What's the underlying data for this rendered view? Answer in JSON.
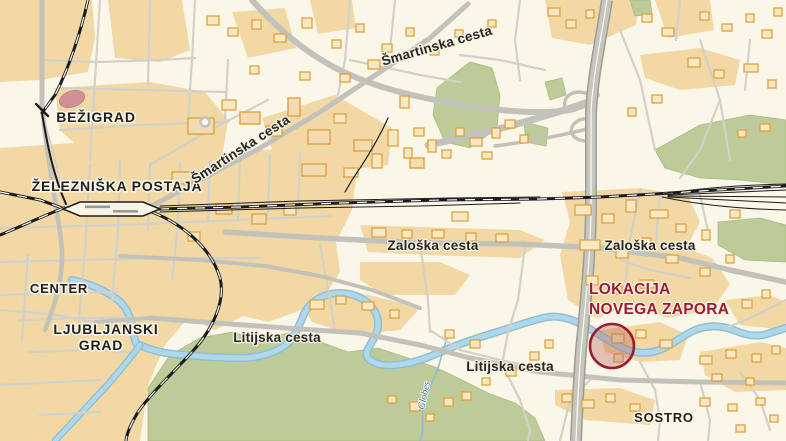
{
  "labels": {
    "districts": {
      "bezigrad": "BEŽIGRAD",
      "center": "CENTER",
      "ljubljanski_grad_line1": "LJUBLJANSKI",
      "ljubljanski_grad_line2": "GRAD",
      "sostro": "SOSTRO"
    },
    "station": "ŽELEZNIŠKA POSTAJA",
    "roads": {
      "smartinska": "Šmartinska cesta",
      "zaloska": "Zaloška cesta",
      "litijska": "Litijska cesta"
    },
    "stream": "Globes",
    "marker": {
      "line1": "LOKACIJA",
      "line2": "NOVEGA ZAPORA"
    }
  },
  "colors": {
    "background": "#faf7e9",
    "urban_area": "#f2d8a5",
    "green_area": "#bccb97",
    "water": "#aed7e9",
    "water_edge": "#8fbdd6",
    "road_major": "#c2c2ba",
    "road_minor": "#d2d1c9",
    "highway_fill": "#c6c6bf",
    "highway_casing": "#9c9c95",
    "railway": "#1c1c1c",
    "building_outline": "#dfa23f",
    "building_fill": "#f7e7c2",
    "stadium": "#cf9098",
    "marker_red": "#9b1b32",
    "label_dark": "#1f1f1f",
    "water_label": "#39749f"
  }
}
